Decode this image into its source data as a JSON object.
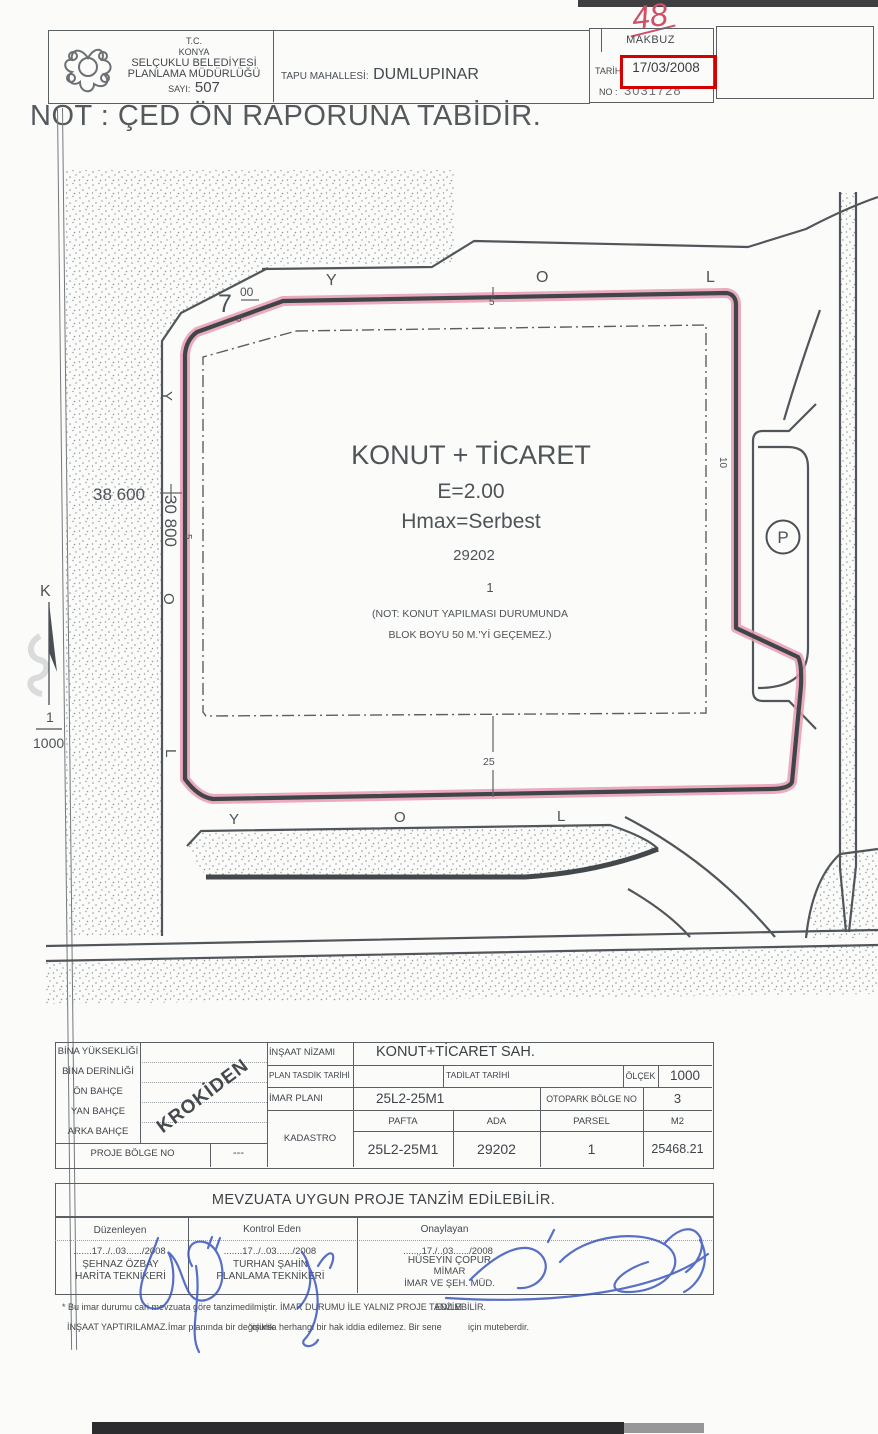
{
  "colors": {
    "accent_red": "#d40000",
    "highlight_pink": "#e89cb2",
    "signature_blue": "#3b57bb"
  },
  "header": {
    "tc": "T.C.",
    "city": "KONYA",
    "org1": "SELÇUKLU BELEDİYESİ",
    "org2": "PLANLAMA MÜDÜRLÜĞÜ",
    "sayi_label": "SAYI:",
    "sayi_value": "507",
    "tapu_label": "TAPU MAHALLESİ:",
    "tapu_value": "DUMLUPINAR",
    "makbuz_title": "MAKBUZ",
    "tarih_label": "TARİH",
    "tarih_value": "17/03/2008",
    "no_label": "NO :",
    "no_value": "3031728",
    "handwritten": "48"
  },
  "note_title": "NOT : ÇED ÖN RAPORUNA TABİDİR.",
  "plan": {
    "zone": "KONUT + TİCARET",
    "e": "E=2.00",
    "hmax": "Hmax=Serbest",
    "ada": "29202",
    "parsel": "1",
    "note1": "(NOT: KONUT YAPILMASI DURUMUNDA",
    "note2": "BLOK BOYU 50 M.'Yİ GEÇEMEZ.)",
    "dim_38600": "38 600",
    "dim_30800": "30 800",
    "dim_7": "7",
    "dim_7_sup": "00",
    "dim_5_top": "5",
    "dim_5_left": "5",
    "dim_5_diag": "5",
    "dim_10": "10",
    "dim_25": "25",
    "top_letters": [
      "Y",
      "O",
      "L"
    ],
    "left_letters": [
      "Y",
      "O",
      "L"
    ],
    "bottom_letters": [
      "Y",
      "O",
      "L"
    ],
    "parking": "P",
    "north": "K",
    "scale_num": "1",
    "scale_den": "1000"
  },
  "table": {
    "left_rows": [
      "BİNA YÜKSEKLİĞİ",
      "BİNA DERİNLİĞİ",
      "ÖN BAHÇE",
      "YAN BAHÇE",
      "ARKA BAHÇE"
    ],
    "krokiden": "KROKİDEN",
    "proje_bolge": {
      "label": "PROJE BÖLGE NO",
      "value": "---"
    },
    "insaat": {
      "label": "İNŞAAT NİZAMI",
      "value": "KONUT+TİCARET SAH."
    },
    "plan_tasdik_label": "PLAN TASDİK TARİHİ",
    "tadilat_label": "TADİLAT TARİHİ",
    "olcek": {
      "label": "ÖLÇEK",
      "value": "1000"
    },
    "imar_plani": {
      "label": "İMAR PLANI",
      "value": "25L2-25M1"
    },
    "otopark": {
      "label": "OTOPARK BÖLGE NO",
      "value": "3"
    },
    "kadastro_label": "KADASTRO",
    "cols": {
      "pafta": "PAFTA",
      "ada": "ADA",
      "parsel": "PARSEL",
      "m2": "M2"
    },
    "vals": {
      "pafta": "25L2-25M1",
      "ada": "29202",
      "parsel": "1",
      "m2": "25468.21"
    }
  },
  "statement": "MEVZUATA UYGUN PROJE TANZİM EDİLEBİLİR.",
  "signatures": {
    "columns": [
      {
        "role": "Düzenleyen",
        "date": ".......17../..03....../2008",
        "name": "ŞEHNAZ ÖZBAY",
        "title": "HARİTA TEKNİKERİ"
      },
      {
        "role": "Kontrol Eden",
        "date": ".......17../..03....../2008",
        "name": "TURHAN ŞAHİN",
        "title": "PLANLAMA TEKNİKERİ"
      },
      {
        "role": "Onaylayan",
        "date": ".......17./..03....../2008",
        "name": "HÜSEYİN ÇOPUR",
        "title": "MİMAR",
        "title2": "İMAR VE ŞEH. MÜD."
      }
    ]
  },
  "footnote": {
    "f1a": "* Bu imar durumu cari mevzuata göre tanzim",
    "f1b": "edilmiştir. İMAR DURUMU İLE YALNIZ PROJE TANZİM",
    "f1c": "EDİLEBİLİR.",
    "f2a": "İNŞAAT YAPTIRILAMAZ.İmar planında bir değişiklik",
    "f2b": "olursa herhangi bir hak iddia edilemez. Bir sene",
    "f2c": "için muteberdir."
  }
}
